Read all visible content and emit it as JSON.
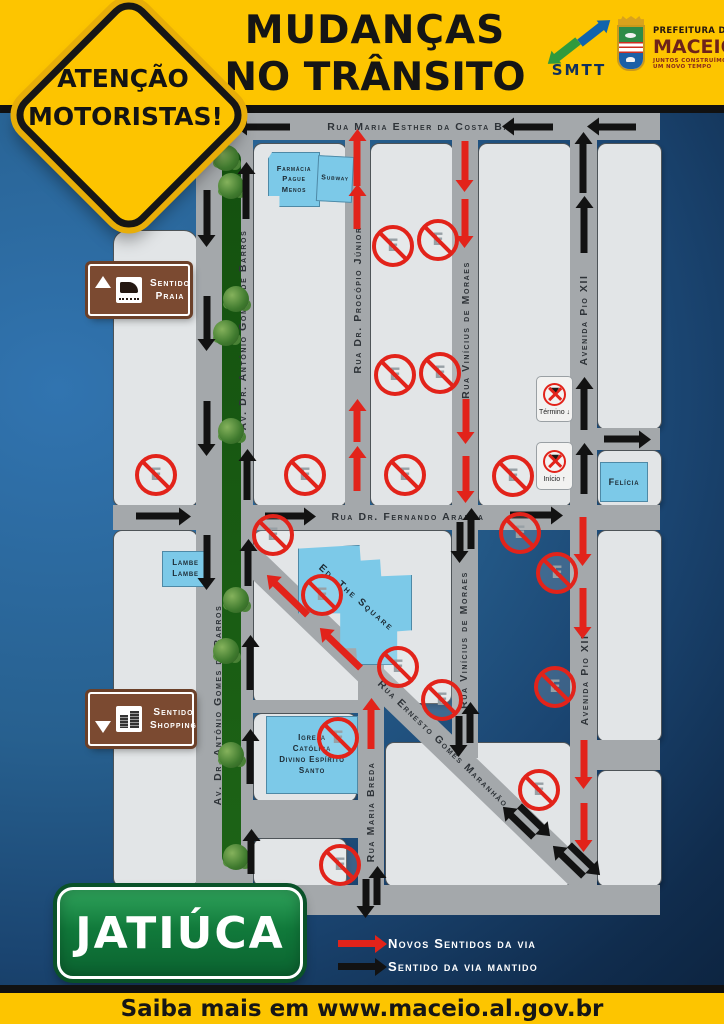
{
  "colors": {
    "red": "#e2231a",
    "black": "#121212",
    "header_yellow": "#fdc500",
    "sign_brown": "#7b4a31",
    "building_blue": "#7cc9e8",
    "district_green": "#117a3b",
    "street_gray": "#a4a8ab",
    "block_gray": "#e2e5e7",
    "median_green": "#1d6316"
  },
  "header": {
    "title_line1": "MUDANÇAS",
    "title_line2": "NO TRÂNSITO",
    "attention_line1": "ATENÇÃO",
    "attention_line2": "MOTORISTAS!",
    "smtt_label": "SMTT",
    "prefeitura": {
      "line1": "PREFEITURA DE",
      "name": "MACEIÓ",
      "tagline1": "JUNTOS CONSTRUÍMOS",
      "tagline2": "UM NOVO TEMPO"
    }
  },
  "map": {
    "streets": {
      "maria_esther": "Rua Maria Esther da Costa Barros",
      "gomes_barros_upper": "Av. Dr. Antônio Gomes de Barros",
      "gomes_barros_lower": "Av. Dr. Antônio Gomes de Barros",
      "procopio": "Rua Dr. Procópio Júnior",
      "vinicius_upper": "Rua Vinícius de Moraes",
      "vinicius_lower": "Rua Vinícius de Moraes",
      "pio_xii_upper": "Avenida Pio XII",
      "pio_xii_lower": "Avenida Pio XII",
      "fernando_aranha": "Rua Dr. Fernando Aranha",
      "ernesto": "Rua Ernesto Gomes Maranhão",
      "maria_breda": "Rua Maria Breda"
    },
    "buildings": {
      "farmacia": [
        "Farmácia",
        "Pague",
        "Menos"
      ],
      "subway": "Subway",
      "felicia": "Felícia",
      "lambe": [
        "Lambe",
        "Lambe"
      ],
      "square": "Ed. The Square",
      "igreja": [
        "Igreja",
        "Católica",
        "Divino Espírito",
        "Santo"
      ]
    },
    "signs": {
      "praia": [
        "Sentido",
        "Praia"
      ],
      "shopping": [
        "Sentido",
        "Shopping"
      ],
      "termino": "Término ↓",
      "inicio": "Início ↑"
    },
    "arrows": [
      {
        "x": 268,
        "y": 127,
        "r": 180,
        "l": 44
      },
      {
        "x": 533,
        "y": 127,
        "r": 180,
        "l": 40
      },
      {
        "x": 617,
        "y": 127,
        "r": 180,
        "l": 38
      },
      {
        "x": 207,
        "y": 213,
        "r": 90,
        "l": 46
      },
      {
        "x": 207,
        "y": 318,
        "r": 90,
        "l": 44
      },
      {
        "x": 207,
        "y": 423,
        "r": 90,
        "l": 44
      },
      {
        "x": 207,
        "y": 557,
        "r": 90,
        "l": 44
      },
      {
        "x": 246,
        "y": 196,
        "r": -90,
        "l": 46
      },
      {
        "x": 247,
        "y": 480,
        "r": -90,
        "l": 40
      },
      {
        "x": 248,
        "y": 568,
        "r": -90,
        "l": 36
      },
      {
        "x": 250,
        "y": 668,
        "r": -90,
        "l": 44
      },
      {
        "x": 250,
        "y": 762,
        "r": -90,
        "l": 44
      },
      {
        "x": 251,
        "y": 857,
        "r": -90,
        "l": 34
      },
      {
        "x": 357,
        "y": 163,
        "r": -90,
        "l": 46,
        "c": "red"
      },
      {
        "x": 357,
        "y": 212,
        "r": -90,
        "l": 34,
        "c": "red"
      },
      {
        "x": 357,
        "y": 426,
        "r": -90,
        "l": 32,
        "c": "red"
      },
      {
        "x": 357,
        "y": 474,
        "r": -90,
        "l": 34,
        "c": "red"
      },
      {
        "x": 465,
        "y": 161,
        "r": 90,
        "l": 40,
        "c": "red"
      },
      {
        "x": 465,
        "y": 218,
        "r": 90,
        "l": 38,
        "c": "red"
      },
      {
        "x": 466,
        "y": 416,
        "r": 90,
        "l": 34,
        "c": "red"
      },
      {
        "x": 466,
        "y": 474,
        "r": 90,
        "l": 36,
        "c": "red"
      },
      {
        "x": 583,
        "y": 168,
        "r": -90,
        "l": 50
      },
      {
        "x": 584,
        "y": 230,
        "r": -90,
        "l": 46
      },
      {
        "x": 584,
        "y": 409,
        "r": -90,
        "l": 42
      },
      {
        "x": 584,
        "y": 474,
        "r": -90,
        "l": 40
      },
      {
        "x": 622,
        "y": 439,
        "r": 0,
        "l": 36
      },
      {
        "x": 158,
        "y": 516,
        "r": 0,
        "l": 44
      },
      {
        "x": 285,
        "y": 516,
        "r": 0,
        "l": 40
      },
      {
        "x": 531,
        "y": 515,
        "r": 0,
        "l": 42
      },
      {
        "x": 460,
        "y": 537,
        "r": 90,
        "l": 30
      },
      {
        "x": 471,
        "y": 534,
        "r": -90,
        "l": 30
      },
      {
        "x": 459,
        "y": 731,
        "r": 90,
        "l": 30
      },
      {
        "x": 470,
        "y": 728,
        "r": -90,
        "l": 30
      },
      {
        "x": 583,
        "y": 536,
        "r": 90,
        "l": 38,
        "c": "red"
      },
      {
        "x": 583,
        "y": 608,
        "r": 90,
        "l": 40,
        "c": "red"
      },
      {
        "x": 584,
        "y": 759,
        "r": 90,
        "l": 38,
        "c": "red"
      },
      {
        "x": 584,
        "y": 822,
        "r": 90,
        "l": 38,
        "c": "red"
      },
      {
        "x": 291,
        "y": 599,
        "r": 224,
        "l": 46,
        "c": "red"
      },
      {
        "x": 344,
        "y": 652,
        "r": 224,
        "l": 46,
        "c": "red"
      },
      {
        "x": 522,
        "y": 826,
        "r": 224,
        "l": 32
      },
      {
        "x": 531,
        "y": 817,
        "r": 44,
        "l": 32
      },
      {
        "x": 572,
        "y": 865,
        "r": 224,
        "l": 32
      },
      {
        "x": 581,
        "y": 856,
        "r": 44,
        "l": 32
      },
      {
        "x": 371,
        "y": 729,
        "r": -90,
        "l": 40,
        "c": "red"
      },
      {
        "x": 366,
        "y": 893,
        "r": 90,
        "l": 28
      },
      {
        "x": 377,
        "y": 891,
        "r": -90,
        "l": 28
      }
    ],
    "no_parking": [
      [
        156,
        475
      ],
      [
        305,
        475
      ],
      [
        393,
        246
      ],
      [
        438,
        240
      ],
      [
        395,
        375
      ],
      [
        440,
        373
      ],
      [
        405,
        475
      ],
      [
        513,
        476
      ],
      [
        273,
        535
      ],
      [
        322,
        595
      ],
      [
        398,
        667
      ],
      [
        442,
        700
      ],
      [
        520,
        533
      ],
      [
        557,
        573
      ],
      [
        555,
        687
      ],
      [
        539,
        790
      ],
      [
        338,
        738
      ],
      [
        340,
        865
      ]
    ],
    "trees": [
      158,
      186,
      299,
      333,
      431,
      600,
      651,
      755,
      857
    ]
  },
  "footer": {
    "district": "JATIÚCA",
    "legend": [
      {
        "label": "Novos Sentidos da via",
        "color": "red"
      },
      {
        "label": "Sentido da via mantido",
        "color": "black"
      }
    ],
    "more_info": "Saiba mais em www.maceio.al.gov.br"
  }
}
